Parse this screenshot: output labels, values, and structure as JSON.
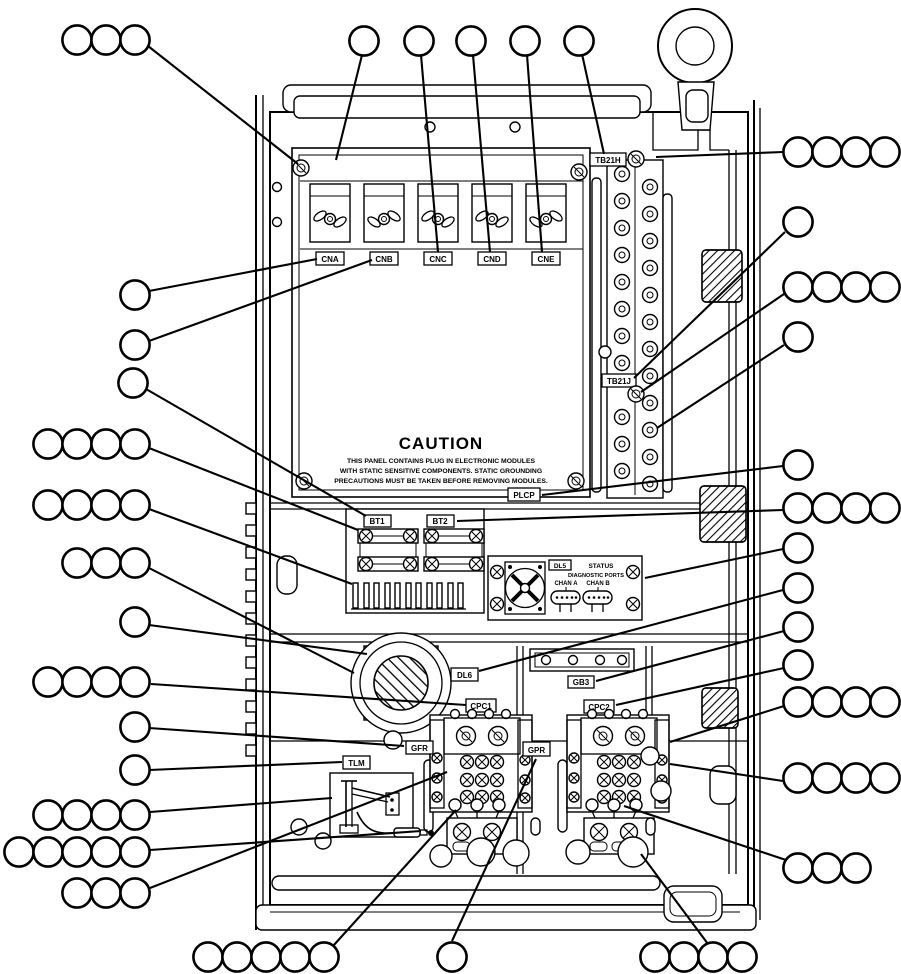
{
  "figure": {
    "caution": {
      "title": "CAUTION",
      "line1": "THIS PANEL CONTAINS PLUG IN ELECTRONIC MODULES",
      "line2": "WITH STATIC SENSITIVE COMPONENTS.  STATIC GROUNDING",
      "line3": "PRECAUTIONS MUST BE TAKEN BEFORE REMOVING MODULES."
    },
    "connectors": {
      "cna": "CNA",
      "cnb": "CNB",
      "cnc": "CNC",
      "cnd": "CND",
      "cne": "CNE"
    },
    "terminal_blocks": {
      "tb21h": "TB21H",
      "tb21j": "TB21J"
    },
    "plcp": "PLCP",
    "batteries": {
      "bt1": "BT1",
      "bt2": "BT2"
    },
    "status_module": {
      "lamp": "DL5",
      "title": "STATUS",
      "subtitle": "DIAGNOSTIC PORTS",
      "chan_a": "CHAN A",
      "chan_b": "CHAN B"
    },
    "components": {
      "dl6": "DL6",
      "gb3": "GB3",
      "cpc1": "CPC1",
      "cpc2": "CPC2",
      "gfr": "GFR",
      "gpr": "GPR",
      "tlm": "TLM"
    }
  }
}
